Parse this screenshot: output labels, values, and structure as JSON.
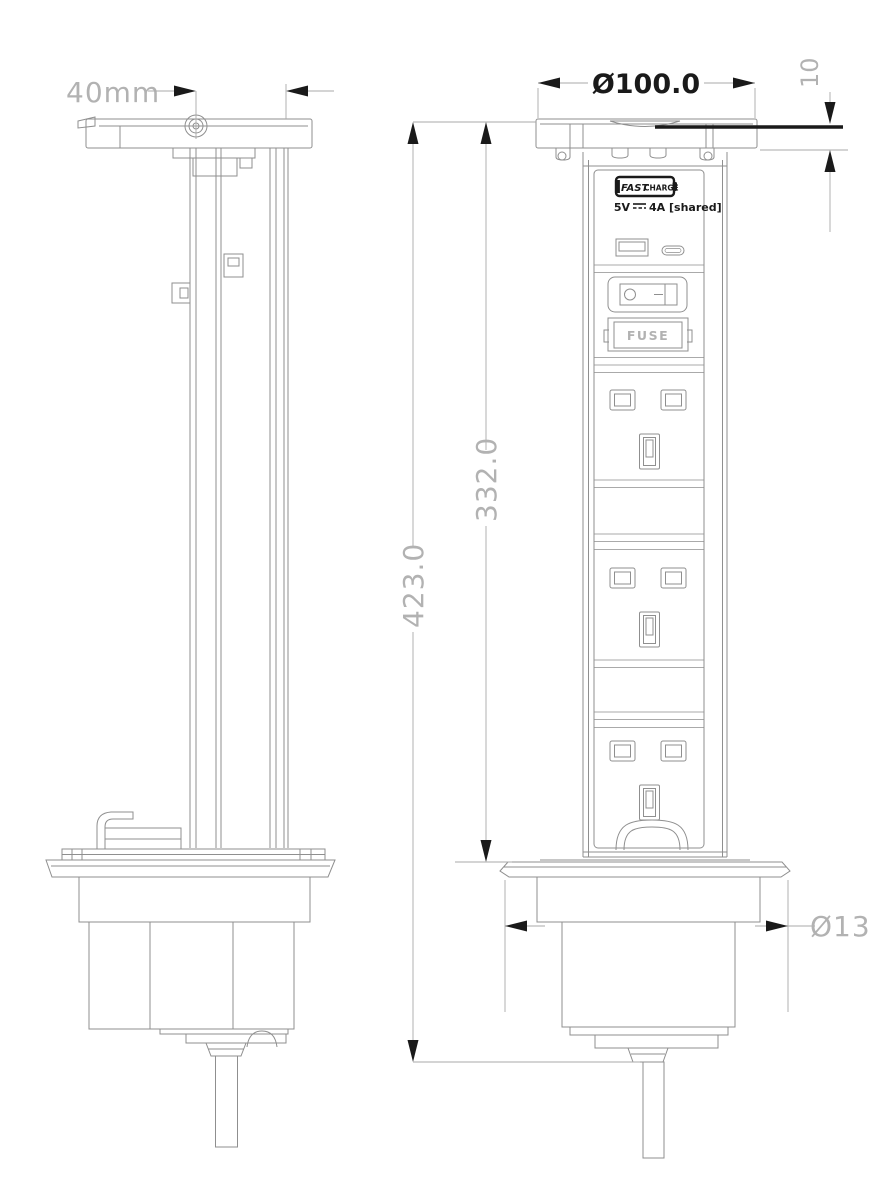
{
  "drawing": {
    "type": "technical-drawing",
    "subject": "pop-up-power-tower-socket",
    "views": {
      "left": "side-view-retracted",
      "right": "front-view-raised"
    },
    "dimensions": {
      "cap_screw_offset": "40mm",
      "head_diameter": "Ø100.0",
      "lid_thickness": "10",
      "overall_height": "423.0",
      "pop_up_height": "332.0",
      "flange_diameter": "Ø130."
    },
    "labels": {
      "fast": "FAST",
      "charge": "CHARGE",
      "usb_volts": "5V",
      "usb_amps": "4A [shared]",
      "fuse": "FUSE"
    },
    "features": {
      "usb_ports": [
        "usb-a",
        "usb-c"
      ],
      "power_switch": true,
      "fuse_holder": true,
      "uk_socket_count": 3
    },
    "colors": {
      "line_gray": "#8f8f8f",
      "dim_line": "#a9a9a9",
      "dim_gray": "#b2b2b2",
      "ink": "#1a1a1a",
      "background": "#ffffff"
    }
  }
}
